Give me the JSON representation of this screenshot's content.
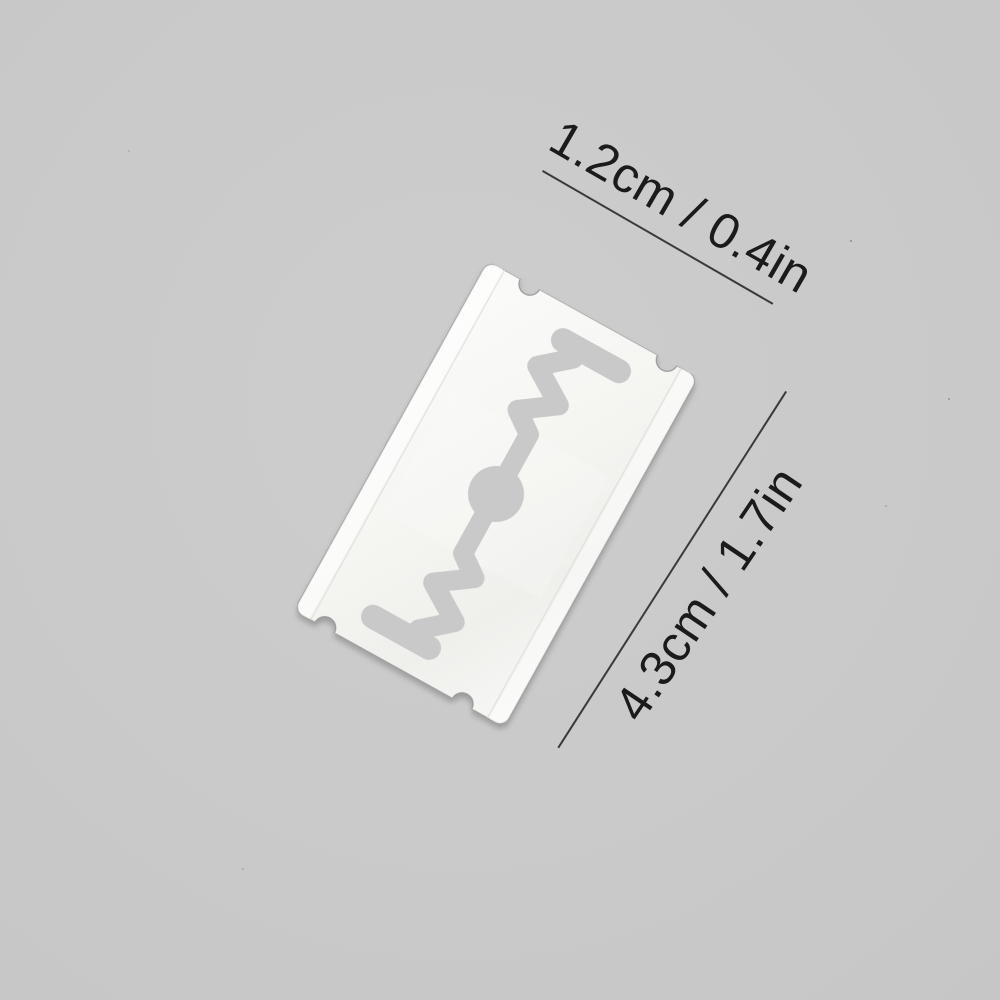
{
  "scene": {
    "description": "Product photo of a stainless steel double-edge safety razor blade lying diagonally on a plain gray backdrop with printed size measurements",
    "object_name": "double-edge razor blade",
    "background_color": "#c9c9c9",
    "blade_color": "#f4f4f1",
    "blade_edge_color": "#9b9b9b",
    "dimension_line_color": "#3a3a3a",
    "text_color": "#1b1b1b"
  },
  "annotations": {
    "width_label": "1.2cm / 0.4in",
    "length_label": "4.3cm / 1.7in"
  }
}
